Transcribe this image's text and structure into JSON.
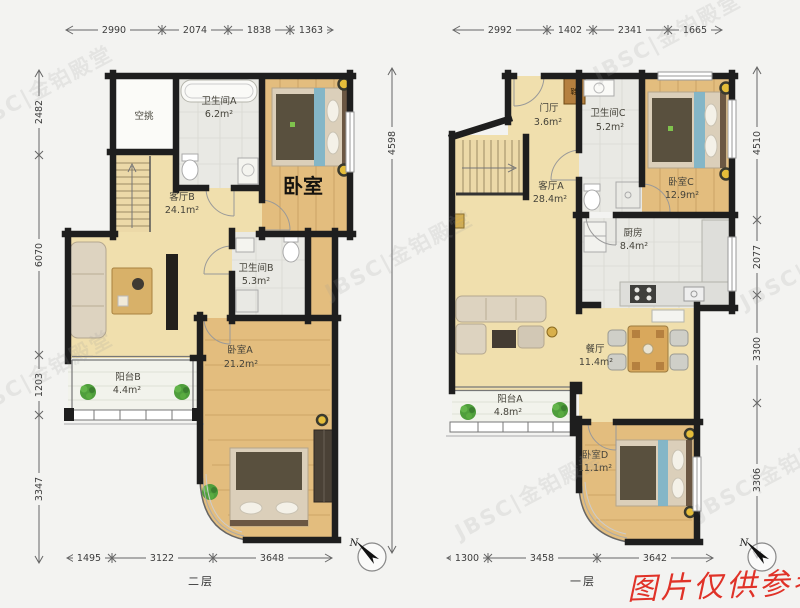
{
  "floor2": {
    "label": "二层",
    "dims_top": [
      "2990",
      "2074",
      "1838",
      "1363"
    ],
    "dims_left": [
      "2482",
      "6070",
      "1203",
      "3347"
    ],
    "dims_bottom": [
      "1495",
      "3122",
      "3648"
    ],
    "dim_total_height": "4598",
    "rooms": {
      "void": {
        "name": "空挑"
      },
      "bath_a": {
        "name": "卫生间A",
        "area": "6.2m²"
      },
      "living_b": {
        "name": "客厅B",
        "area": "24.1m²"
      },
      "bedroom_annotation": "卧室",
      "bath_b": {
        "name": "卫生间B",
        "area": "5.3m²"
      },
      "bed_a": {
        "name": "卧室A",
        "area": "21.2m²"
      },
      "balcony_b": {
        "name": "阳台B",
        "area": "4.4m²"
      }
    }
  },
  "floor1": {
    "label": "一层",
    "dims_top": [
      "2992",
      "1402",
      "2341",
      "1665"
    ],
    "dims_right": [
      "4510",
      "2077",
      "3300",
      "3306"
    ],
    "dims_bottom": [
      "1300",
      "3458",
      "3642"
    ],
    "rooms": {
      "foyer": {
        "name": "门厅",
        "area": "3.6m²"
      },
      "bath_c": {
        "name": "卫生间C",
        "area": "5.2m²"
      },
      "bed_c": {
        "name": "卧室C",
        "area": "12.9m²"
      },
      "living_a": {
        "name": "客厅A",
        "area": "28.4m²"
      },
      "kitchen": {
        "name": "厨房",
        "area": "8.4m²"
      },
      "dining": {
        "name": "餐厅",
        "area": "11.4m²"
      },
      "balcony_a": {
        "name": "阳台A",
        "area": "4.8m²"
      },
      "bed_d": {
        "name": "卧室D",
        "area": "11.1m²"
      },
      "shoe_cabinet": {
        "name": "鞋"
      }
    }
  },
  "compass": {
    "north_label": "N"
  },
  "watermarks": {
    "reference_note": "图片仅供参考",
    "brand": "JBSC|金铂殿堂"
  },
  "colors": {
    "wall": "#1e1e1e",
    "floor_tan": "#f0dfad",
    "floor_wood": "#e3bd7e",
    "floor_tile": "#e9e9e4",
    "reference_note_red": "#e03228"
  }
}
